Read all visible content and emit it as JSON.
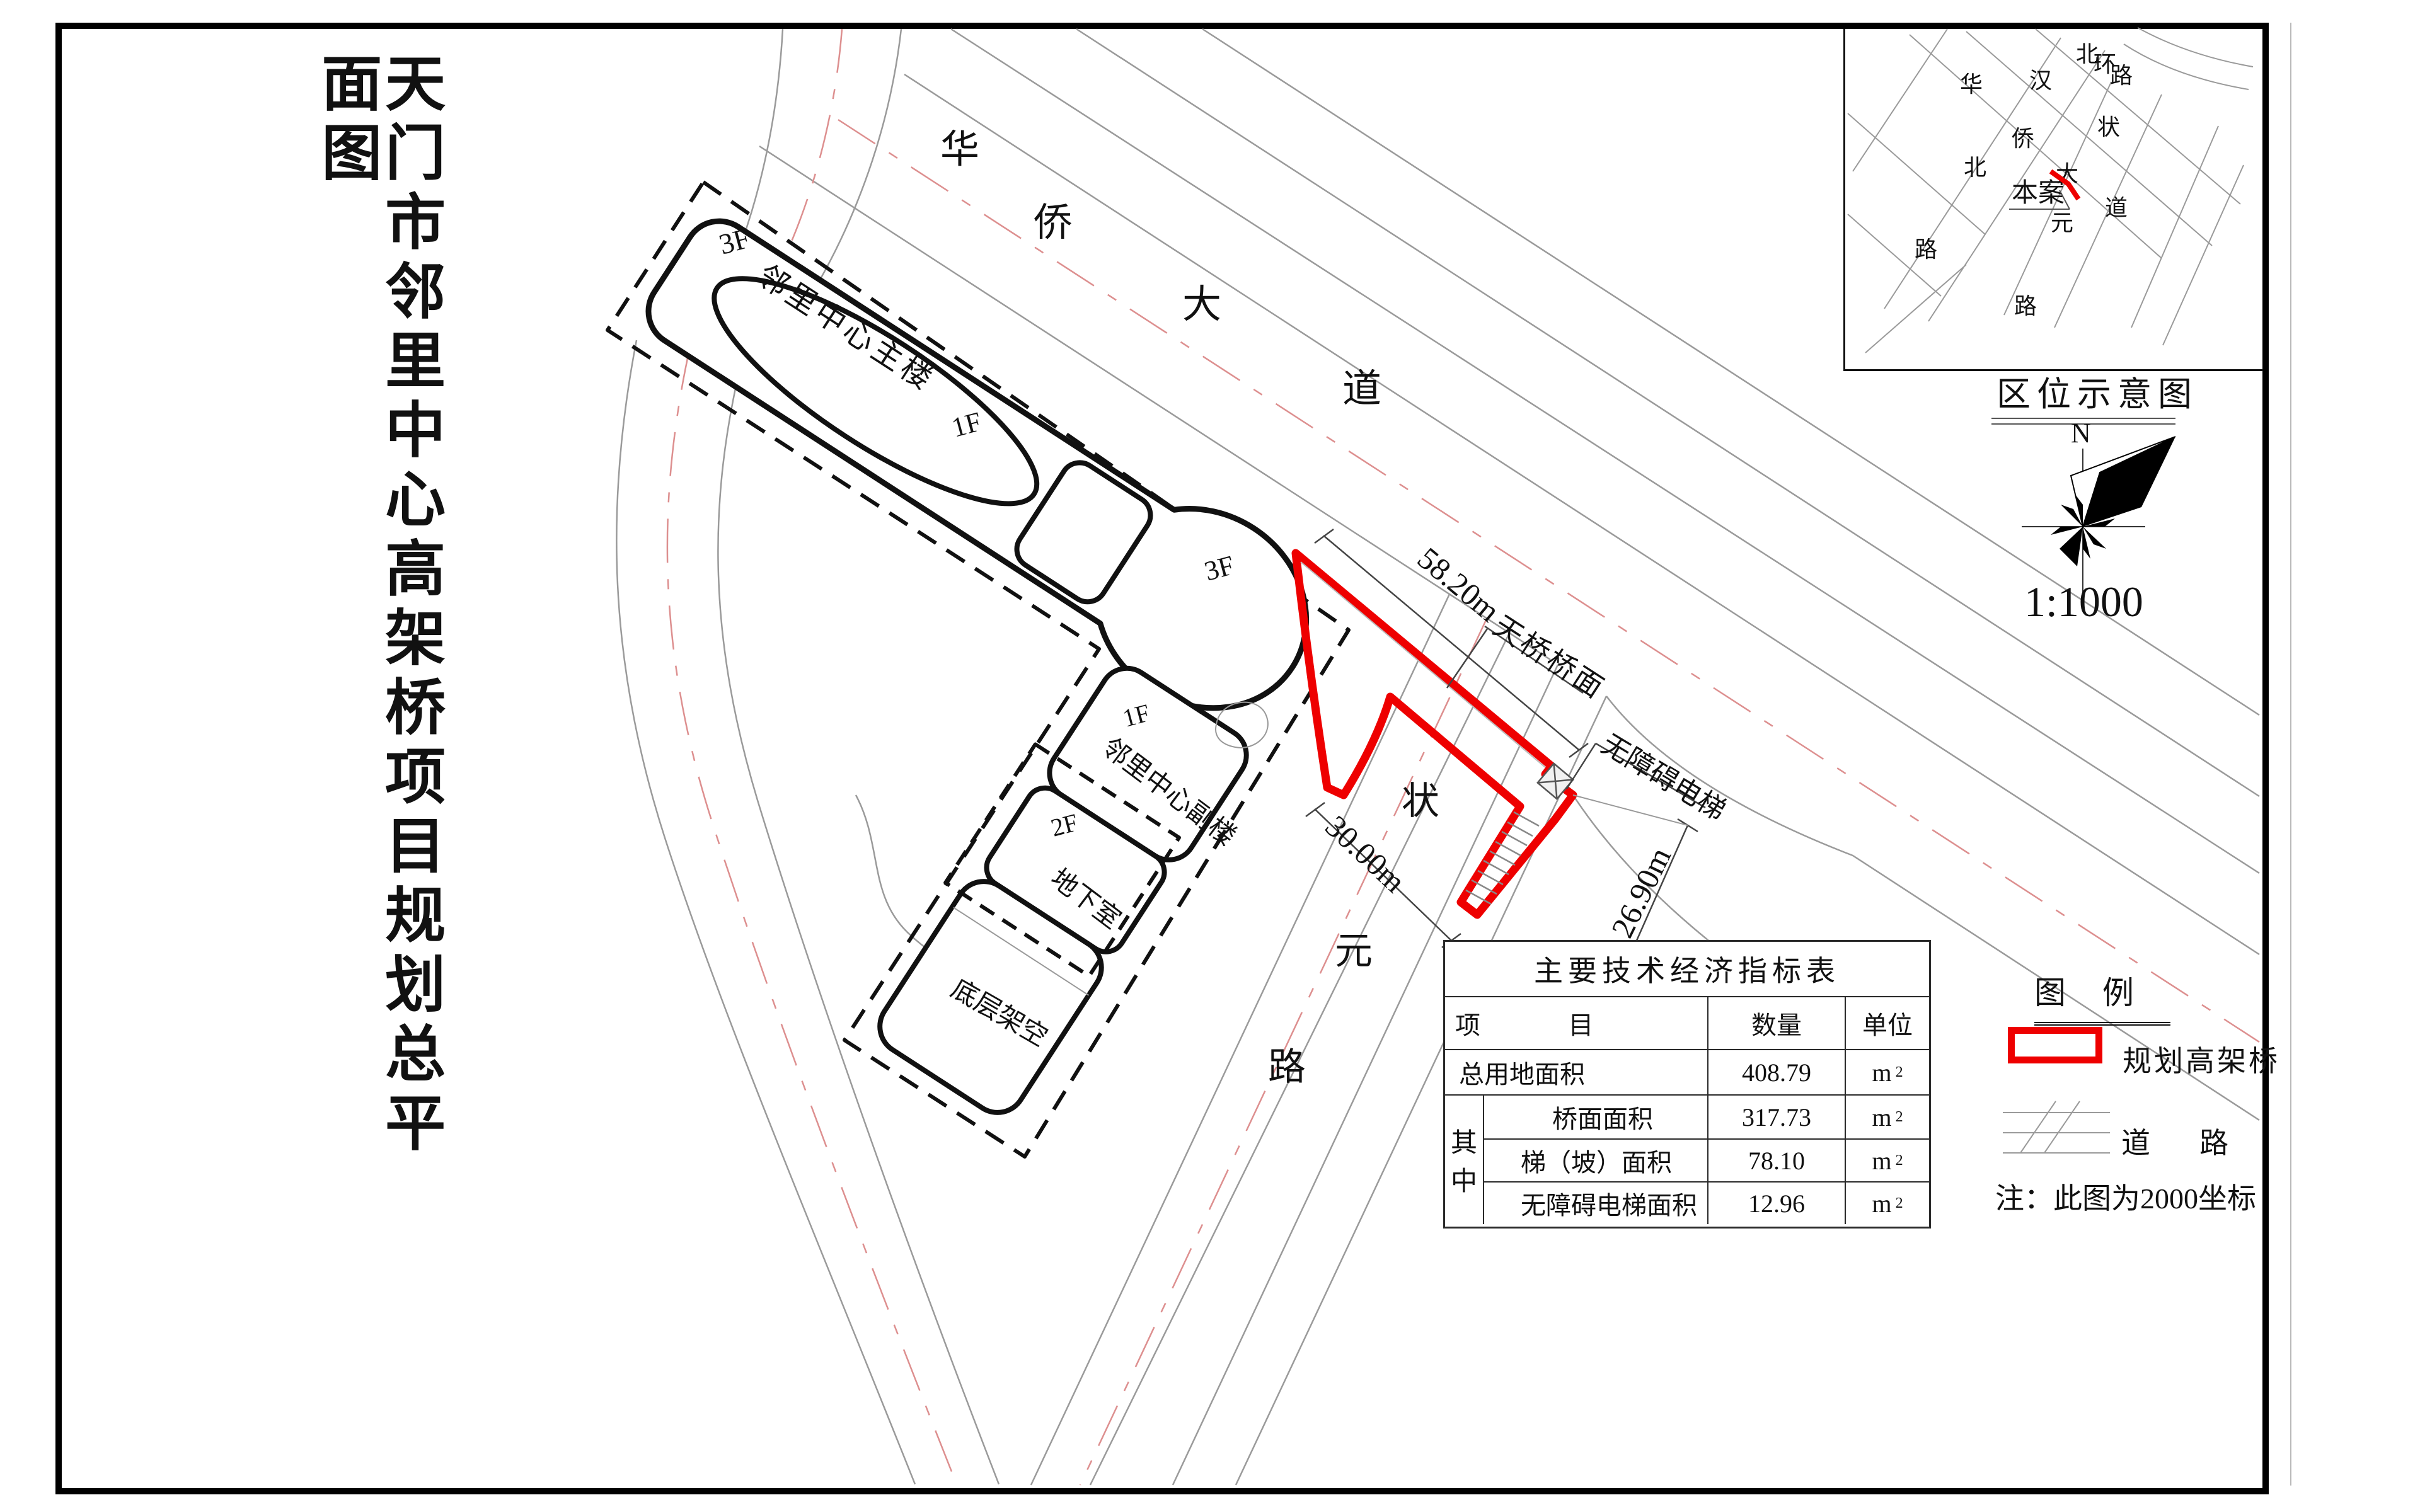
{
  "page_title": "天门市邻里中心高架桥项目规划总平面图",
  "plan": {
    "buildings": {
      "main_floor": "3F",
      "main_name": "邻里中心主楼",
      "atrium": "1F",
      "wing": "3F",
      "annex_floor": "1F",
      "annex_name": "邻里中心副楼",
      "block2": "2F",
      "basement": "地下室",
      "stilt": "底层架空"
    },
    "roads": {
      "hua": "华",
      "qiao": "侨",
      "da": "大",
      "dao": "道",
      "zhuang": "状",
      "yuan": "元",
      "lu": "路"
    },
    "bridge": {
      "deck": "天桥桥面",
      "elevator": "无障碍电梯"
    },
    "dims": {
      "deck_len": "58.20m",
      "road_w": "30.00m",
      "ramp_len": "26.90m"
    }
  },
  "inset": {
    "title": "区位示意图",
    "north": "N",
    "scale": "1:1000",
    "site": "本案",
    "chars": {
      "bei1": "北",
      "huan": "环",
      "lu1": "路",
      "han": "汉",
      "hua": "华",
      "qiao": "侨",
      "bei2": "北",
      "lu2": "路",
      "zhuang": "状",
      "da": "大",
      "dao": "道",
      "yuan": "元",
      "lu3": "路"
    }
  },
  "table": {
    "title": "主要技术经济指标表",
    "h_item1": "项",
    "h_item2": "目",
    "h_qty": "数量",
    "h_unit": "单位",
    "group1": "其",
    "group2": "中",
    "unit_base": "m",
    "unit_sup": "2",
    "rows": [
      {
        "name": "总用地面积",
        "qty": "408.79"
      },
      {
        "name": "桥面面积",
        "qty": "317.73"
      },
      {
        "name": "梯（坡）面积",
        "qty": "78.10"
      },
      {
        "name": "无障碍电梯面积",
        "qty": "12.96"
      }
    ]
  },
  "legend": {
    "title": "图例",
    "bridge": "规划高架桥",
    "road": "道路",
    "note": "注：此图为2000坐标"
  },
  "colors": {
    "bridge_red": "#ee0000",
    "centerline_pink": "#dd8f8f",
    "road_gray": "#9a9a9a",
    "ink": "#111111"
  }
}
